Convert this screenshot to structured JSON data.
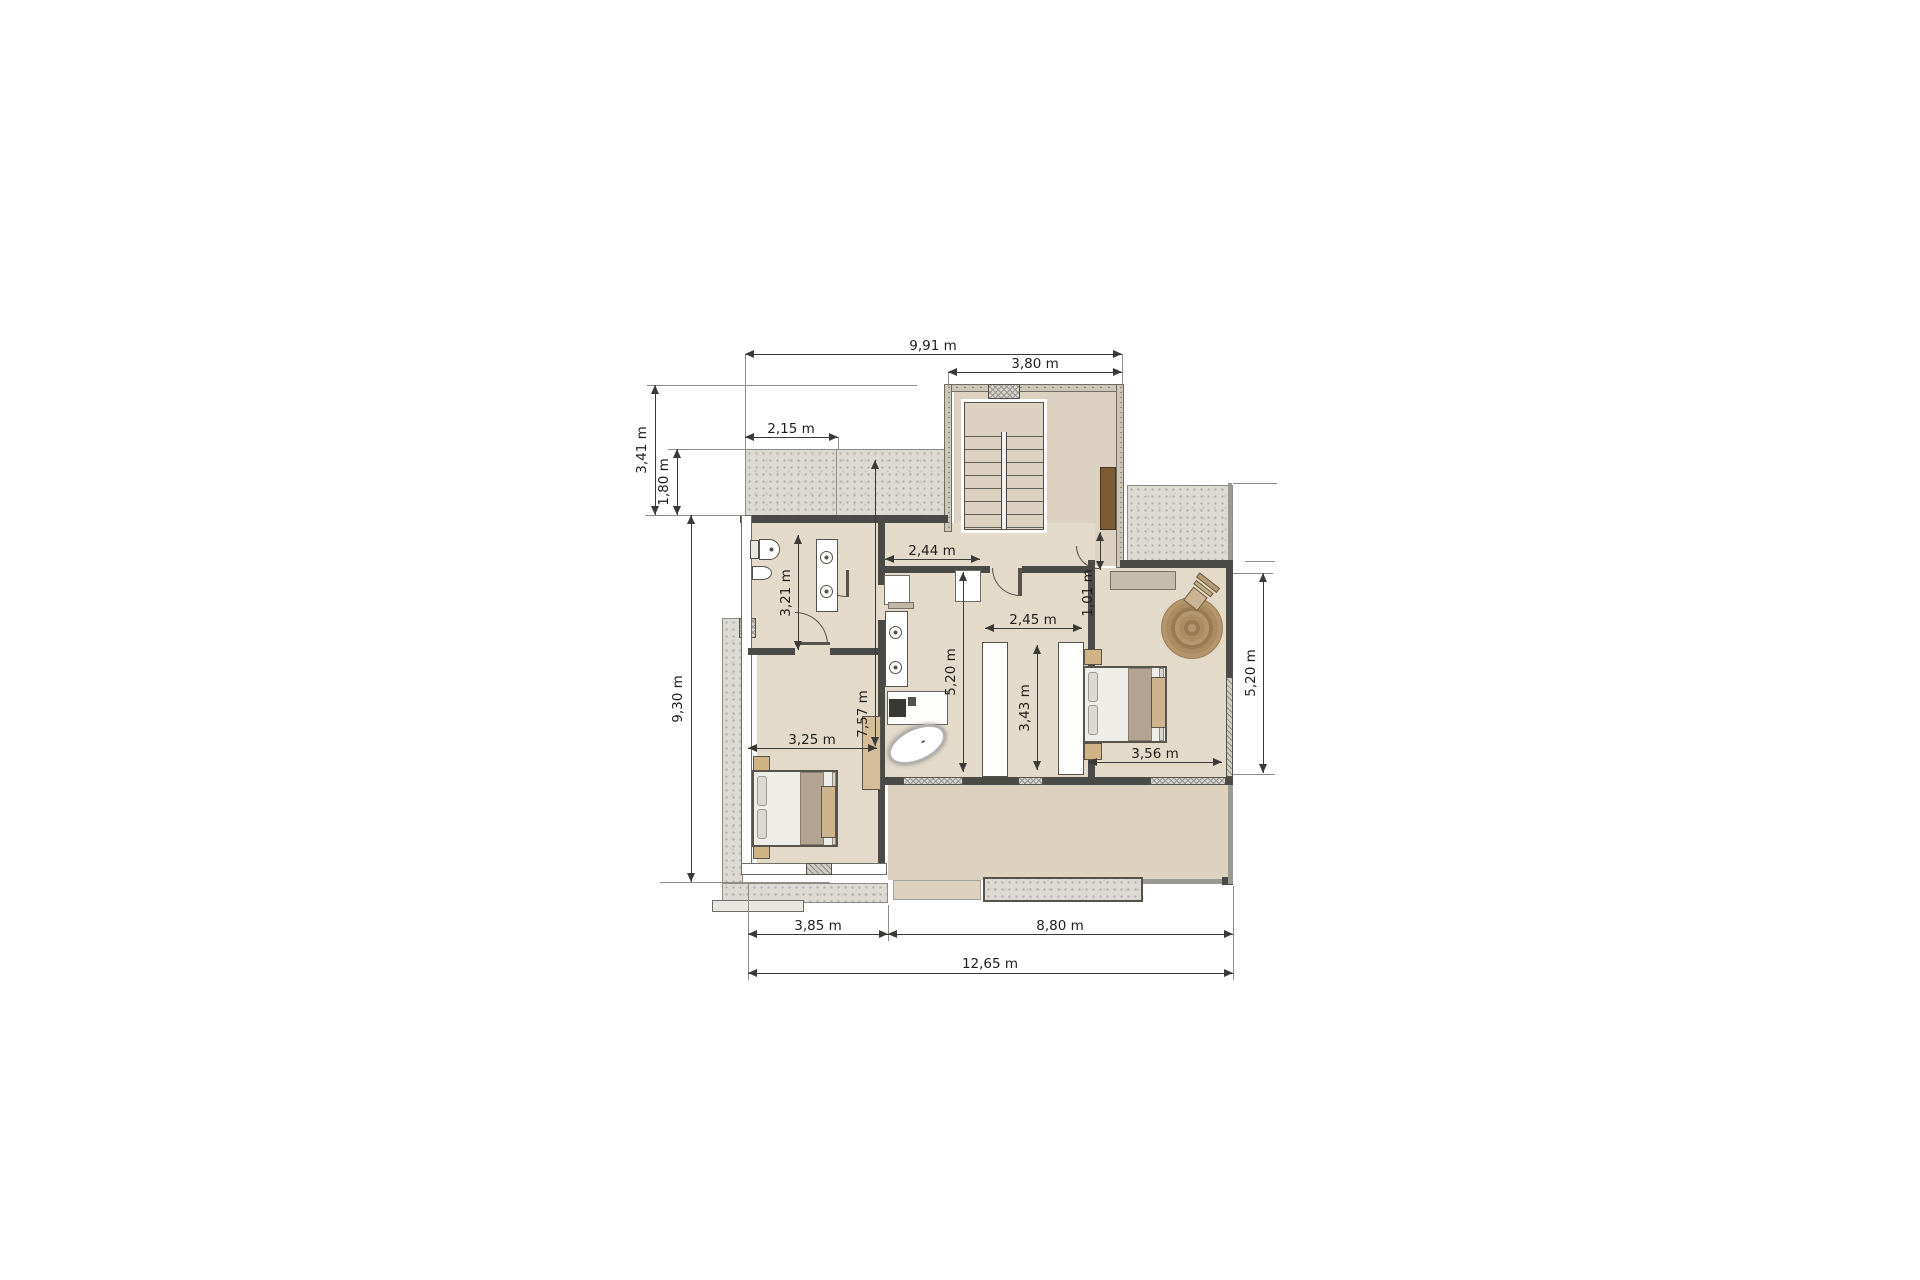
{
  "drawing": {
    "type": "floor-plan",
    "unit": "m",
    "rooms": [
      "stairwell",
      "hallway",
      "bathroom-left",
      "bathroom-center",
      "walk-in-closet",
      "bedroom-left",
      "bedroom-right",
      "terrace-upper-left",
      "terrace-upper-right",
      "terrace-lower",
      "balcony-strip"
    ],
    "furniture": [
      "stairs",
      "toilet",
      "bidet",
      "double-washbasin-left",
      "double-washbasin-center",
      "vanity-island",
      "freestanding-bathtub",
      "wardrobe-column-left",
      "wardrobe-column-right",
      "bed-left",
      "bed-right",
      "nightstands",
      "benches",
      "dresser",
      "round-rug",
      "armchair",
      "wardrobe-left-bedroom",
      "door-brown"
    ]
  },
  "dims": {
    "top_width": "9,91 m",
    "stair_width": "3,80 m",
    "upper_terrace_width": "2,15 m",
    "upper_left_height": "3,41 m",
    "upper_terrace_depth": "1,80 m",
    "left_height": "9,30 m",
    "bathroom1_length": "3,21 m",
    "hallway_length": "2,44 m",
    "entry_offset": "1,01 m",
    "bathroom2_length": "5,20 m",
    "closet_width": "2,45 m",
    "closet_length": "3,43 m",
    "bedroom1_width": "3,25 m",
    "interior_length": "7,57 m",
    "bedroom2_width": "3,56 m",
    "bedroom2_length": "5,20 m",
    "bottom_left_width": "3,85 m",
    "bottom_right_width": "8,80 m",
    "total_width": "12,65 m"
  },
  "colors": {
    "floor_interior": "#e4dac9",
    "floor_terrace": "#ddd1bf",
    "wall_dark": "#4a4a46",
    "gravel": "#dcdad3",
    "door_wood": "#7b5a36",
    "rug_brown": "#a2855b",
    "dimension_text": "#1d1d1b"
  }
}
